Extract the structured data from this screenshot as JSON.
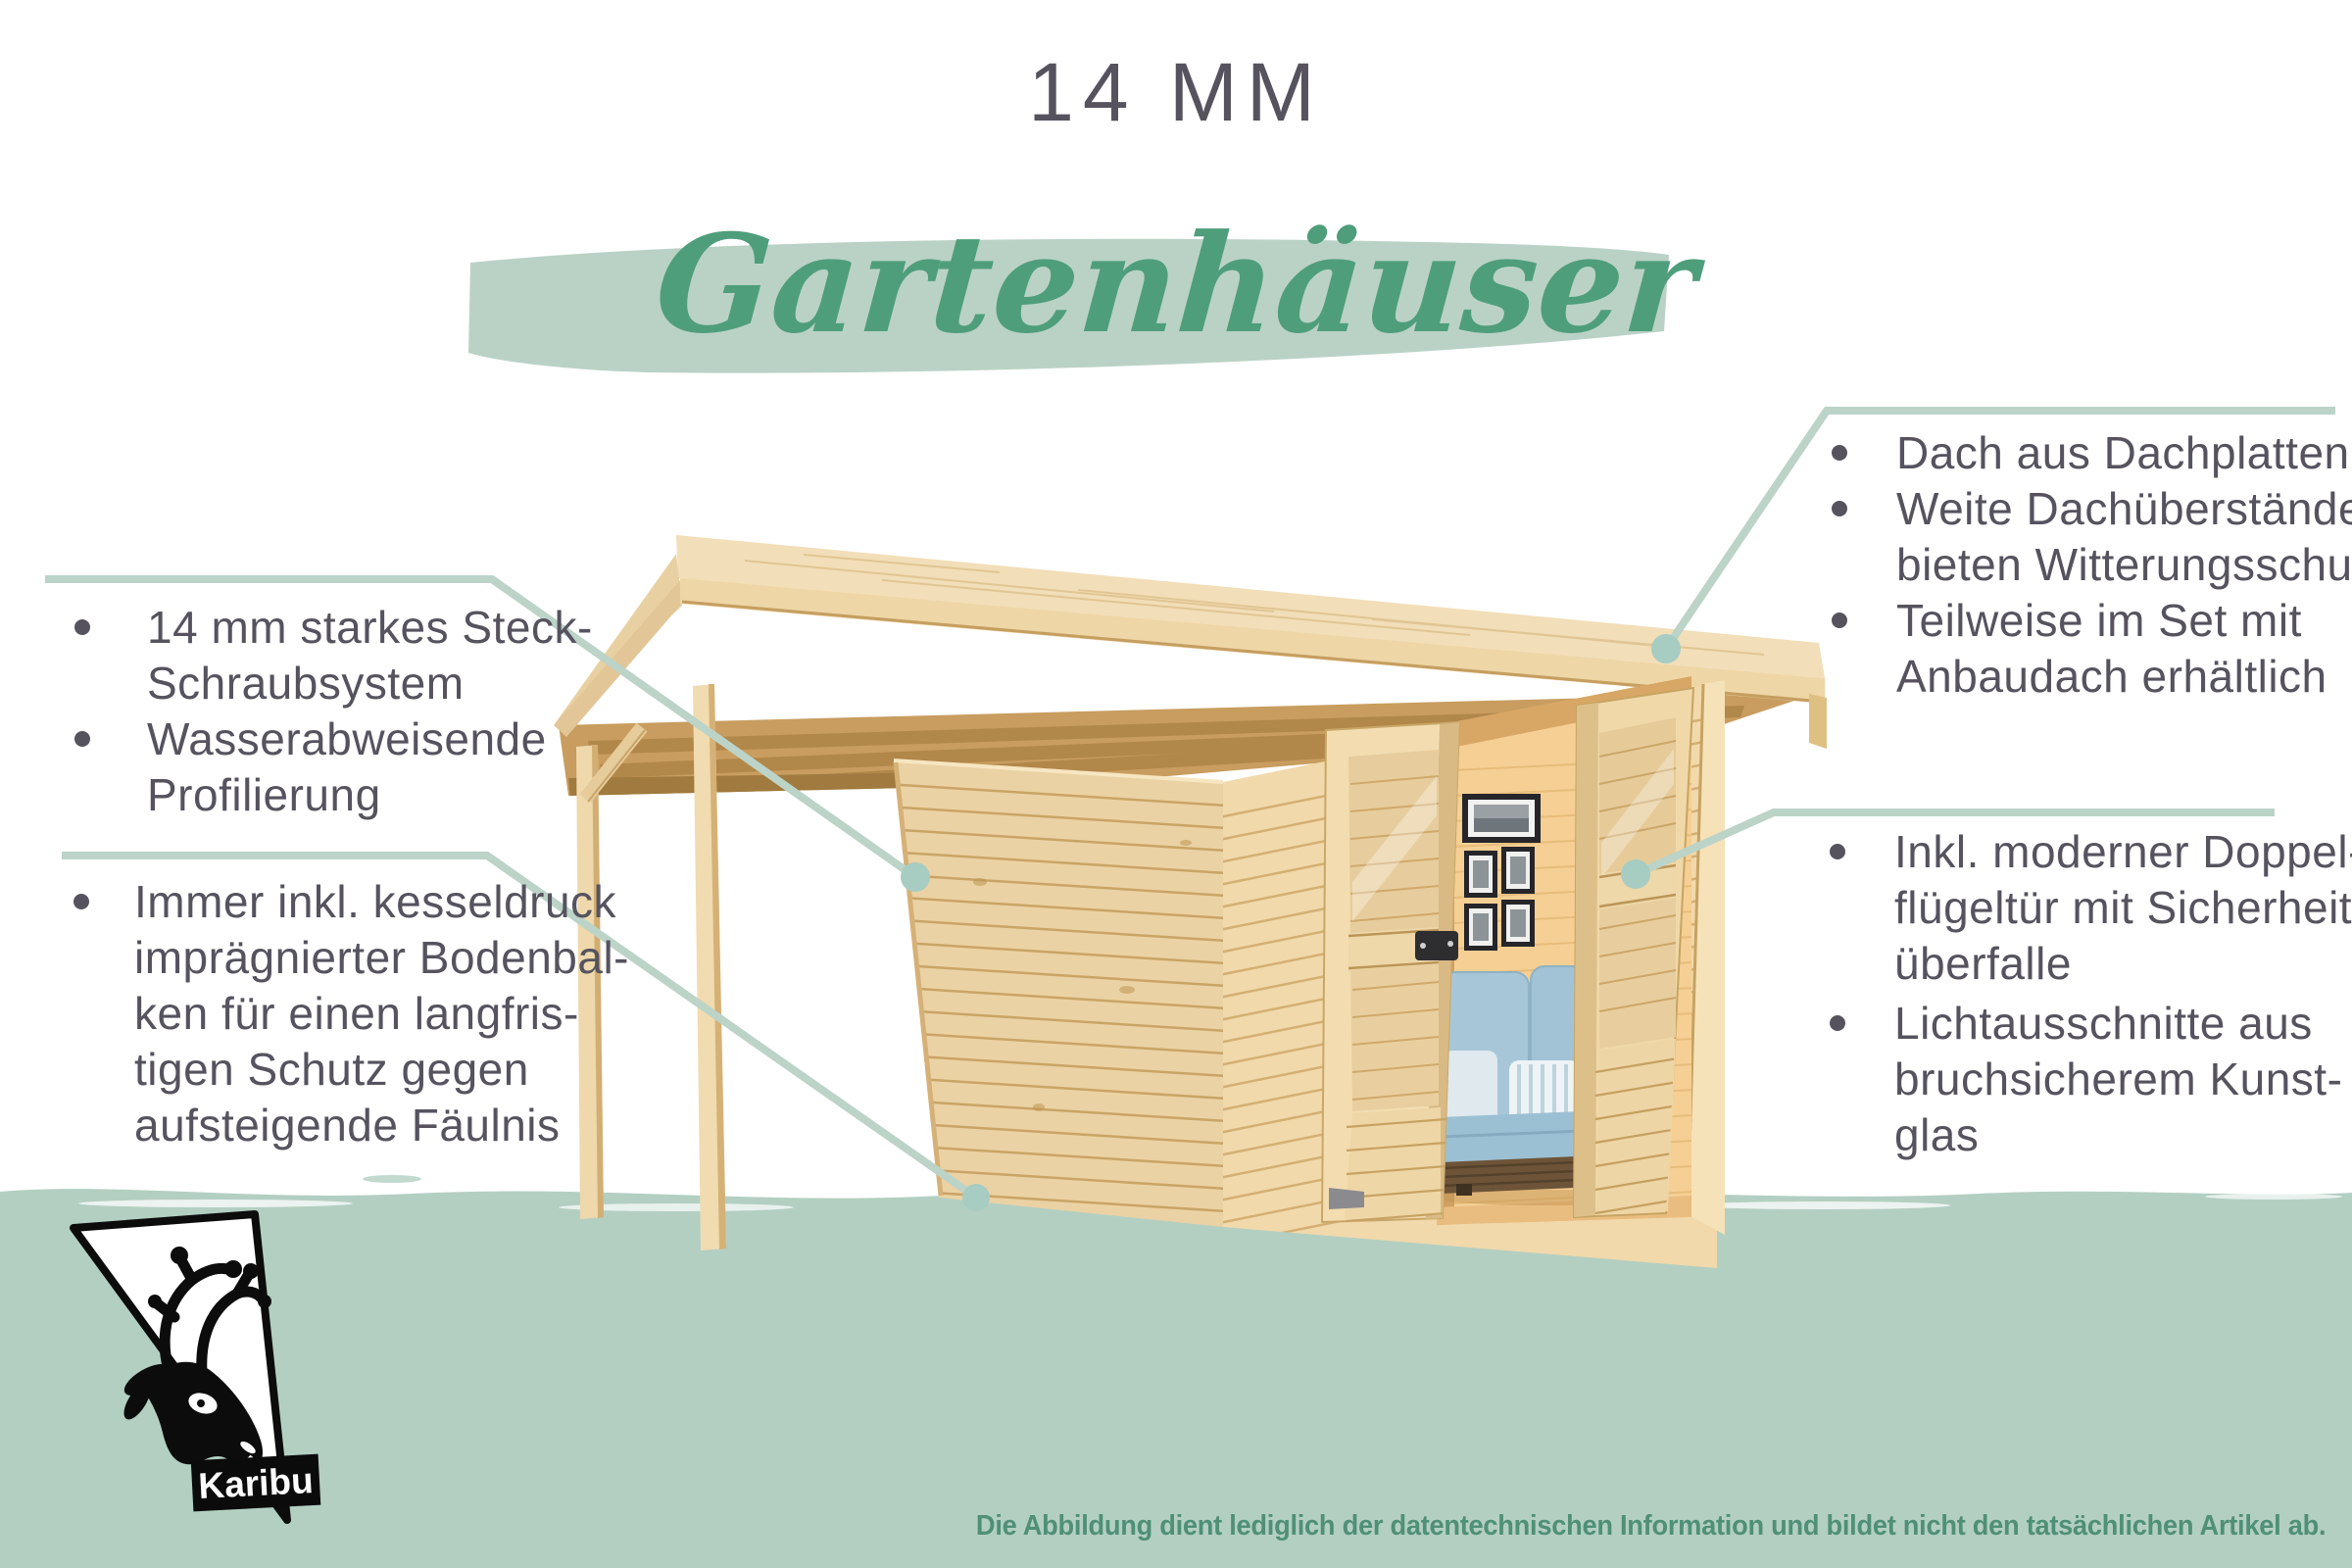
{
  "header": {
    "size_label": "14 MM",
    "script_title": "Gartenhäuser"
  },
  "features_left": [
    {
      "lines": [
        "14 mm starkes Steck-",
        "Schraubsystem"
      ]
    },
    {
      "lines": [
        "Wasserabweisende",
        "Profilierung"
      ]
    },
    {
      "lines": [
        "Immer inkl. kesseldruck",
        "imprägnierter Bodenbal-",
        "ken für einen langfris-",
        "tigen Schutz gegen",
        "aufsteigende Fäulnis"
      ]
    }
  ],
  "features_right": [
    {
      "lines": [
        "Dach aus Dachplatten"
      ]
    },
    {
      "lines": [
        "Weite Dachüberstände",
        "bieten Witterungsschutz"
      ]
    },
    {
      "lines": [
        "Teilweise im Set mit",
        "Anbaudach erhältlich"
      ]
    },
    {
      "lines": [
        "Inkl. moderner Doppel-",
        "flügeltür mit Sicherheits-",
        "überfalle"
      ]
    },
    {
      "lines": [
        "Lichtausschnitte aus",
        "bruchsicherem Kunst-",
        "glas"
      ]
    }
  ],
  "logo": {
    "brand": "Karibu"
  },
  "footer": {
    "disclaimer": "Die Abbildung dient lediglich der datentechnischen Information und bildet nicht den tatsächlichen Artikel ab."
  },
  "colors": {
    "accent_green": "#4f9e7b",
    "brush_green": "#bad2c6",
    "band_green": "#b3cfc2",
    "leader_green": "#bcd3c8",
    "callout_dot_green": "#a7ccc1",
    "text_dark": "#56535f",
    "disclaimer_green": "#4f9077"
  }
}
